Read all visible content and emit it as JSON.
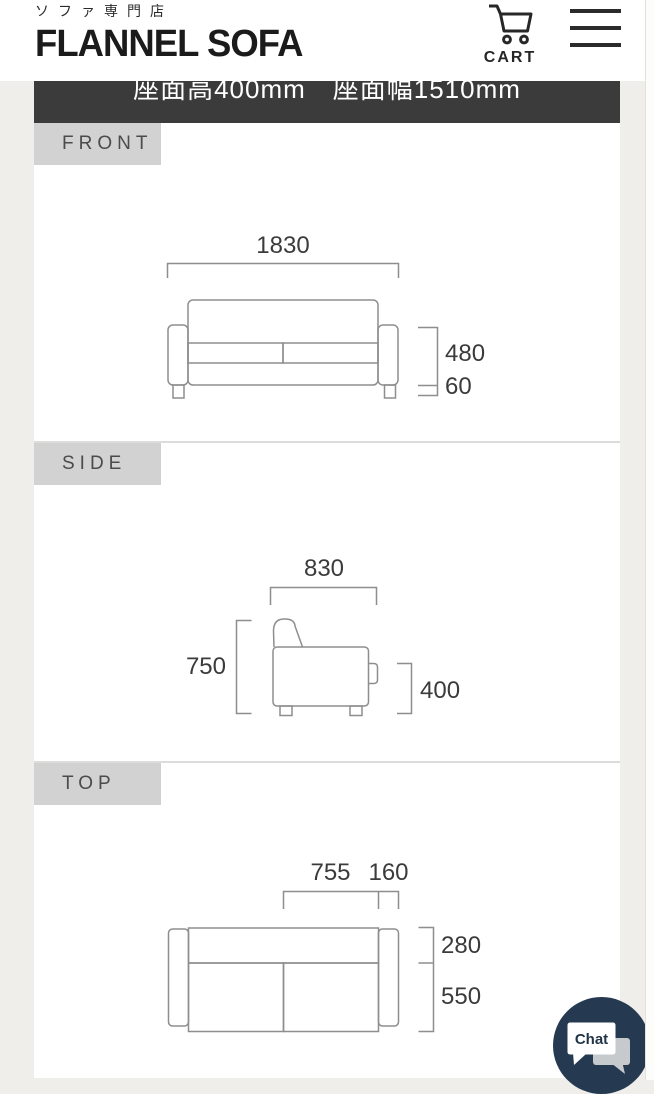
{
  "header": {
    "tagline": "ソファ専門店",
    "logo": "FLANNEL SOFA",
    "cart_label": "CART"
  },
  "spec_bar": {
    "text": "座面高400mm　座面幅1510mm"
  },
  "sections": {
    "front": {
      "label": "FRONT",
      "width": "1830",
      "body_height": "480",
      "leg_height": "60"
    },
    "side": {
      "label": "SIDE",
      "depth": "830",
      "height": "750",
      "seat_height": "400"
    },
    "top": {
      "label": "TOP",
      "seat_width": "755",
      "arm_width": "160",
      "back_depth": "280",
      "seat_depth": "550"
    }
  },
  "chat": {
    "label": "Chat"
  },
  "colors": {
    "page_bg": "#f0eeea",
    "spec_bar_bg": "#3b3b3b",
    "label_bg": "#d2d2d2",
    "diagram_stroke": "#8e8e8e",
    "chat_circle": "#253a50"
  }
}
